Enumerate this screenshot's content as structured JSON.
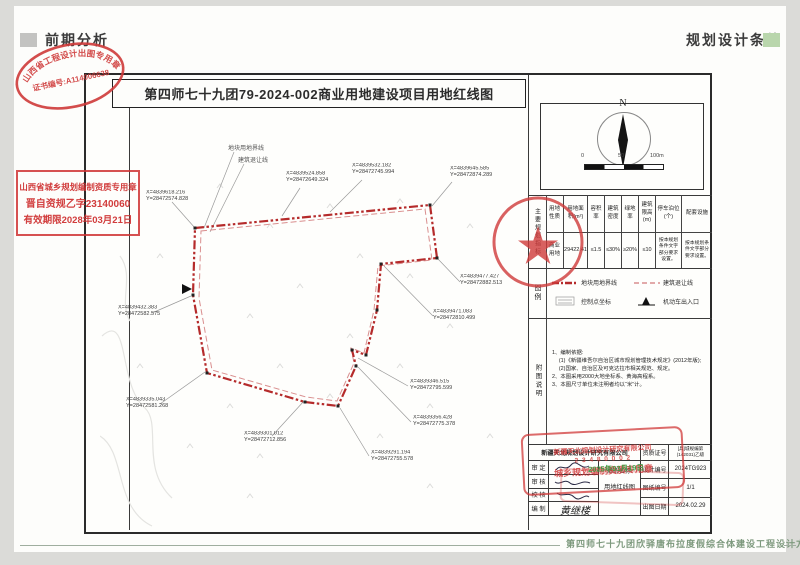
{
  "header": {
    "left_tag": "前期分析",
    "right_tag": "规划设计条件"
  },
  "drawing": {
    "title": "第四师七十九团79-2024-002商业用地建设项目用地红线图"
  },
  "stamps": {
    "oval_arc": "山西省工程设计出图专用章",
    "oval_line": "证书编号:A114006638",
    "box_line1": "山西省城乡规划编制资质专用章",
    "box_line2": "晋自资规乙字23140060",
    "box_line3": "有效期限2028年03月21日",
    "tb_company": "新疆天北规划设计研究有限公司",
    "tb_number": "2 3 4 8 0 0 0 2",
    "tb_title": "城乡规划编制资质专用章",
    "tb_date": "2025年03月19日"
  },
  "map": {
    "boundary_label": "地块用地界线",
    "setback_label": "建筑退让线",
    "coords": [
      {
        "x": "X=4839618.216",
        "y": "Y=28472574.828"
      },
      {
        "x": "X=4839524.858",
        "y": "Y=28472649.324"
      },
      {
        "x": "X=4839532.182",
        "y": "Y=28472745.994"
      },
      {
        "x": "X=4839645.585",
        "y": "Y=28472874.289"
      },
      {
        "x": "X=4839477.427",
        "y": "Y=28472882.513"
      },
      {
        "x": "X=4839471.083",
        "y": "Y=28472810.499"
      },
      {
        "x": "X=4839432.383",
        "y": "Y=28472582.575"
      },
      {
        "x": "X=4839335.043",
        "y": "Y=28472581.268"
      },
      {
        "x": "X=4839346.515",
        "y": "Y=28472795.599"
      },
      {
        "x": "X=4839356.428",
        "y": "Y=28472775.378"
      },
      {
        "x": "X=4839301.012",
        "y": "Y=28472712.856"
      },
      {
        "x": "X=4839291.194",
        "y": "Y=28472755.578"
      }
    ]
  },
  "panel": {
    "north": "N",
    "scale": [
      "0",
      "50",
      "100m"
    ],
    "table": {
      "section": "主要规划指标",
      "headers": [
        "用地性质",
        "用地面积(m²)",
        "容积率",
        "建筑密度",
        "绿地率",
        "建筑限高(m)",
        "停车泊位(个)",
        "配套设施"
      ],
      "row": [
        "商业用地",
        "29422.41",
        "≤1.5",
        "≤30%",
        "≥20%",
        "≤10",
        "按本规划条件文字部分要求设置。",
        "按本规划条件文字部分要求设置。"
      ]
    },
    "legend": {
      "section": "图例",
      "items": [
        "地块用地界线",
        "建筑退让线",
        "控制点坐标",
        "机动车出入口"
      ]
    },
    "notes": {
      "section": "附图说明",
      "lines": [
        "1、编制依据:",
        "(1)《新疆维吾尔自治区城市规划管理技术规定》(2012年版);",
        "(2)国家、自治区及可克达拉市相关规范、规定。",
        "2、本图采用2000大地坐标系、黄海高程系。",
        "3、本图尺寸单位未注明者均以“米”计。"
      ]
    },
    "titleblock": {
      "company": "新疆天北规划设计研究有限公司",
      "cert_label": "资质证号",
      "cert_value": "[兵]城规编第(142031)乙级",
      "row_labels": [
        "审 定",
        "审 核",
        "校 核",
        "编 制"
      ],
      "maker_sig": "黄继楼",
      "name_label": "图纸名称:",
      "name_value": "用地红线图",
      "design_label": "设计编号",
      "design_value": "2024TG923",
      "sheet_label": "图纸编号",
      "sheet_value": "1/1",
      "date_label": "出图日期",
      "date_value": "2024.02.29"
    }
  },
  "footer": {
    "project": "第四师七十九团欣驿唐布拉度假综合体建设工程设计方案"
  }
}
